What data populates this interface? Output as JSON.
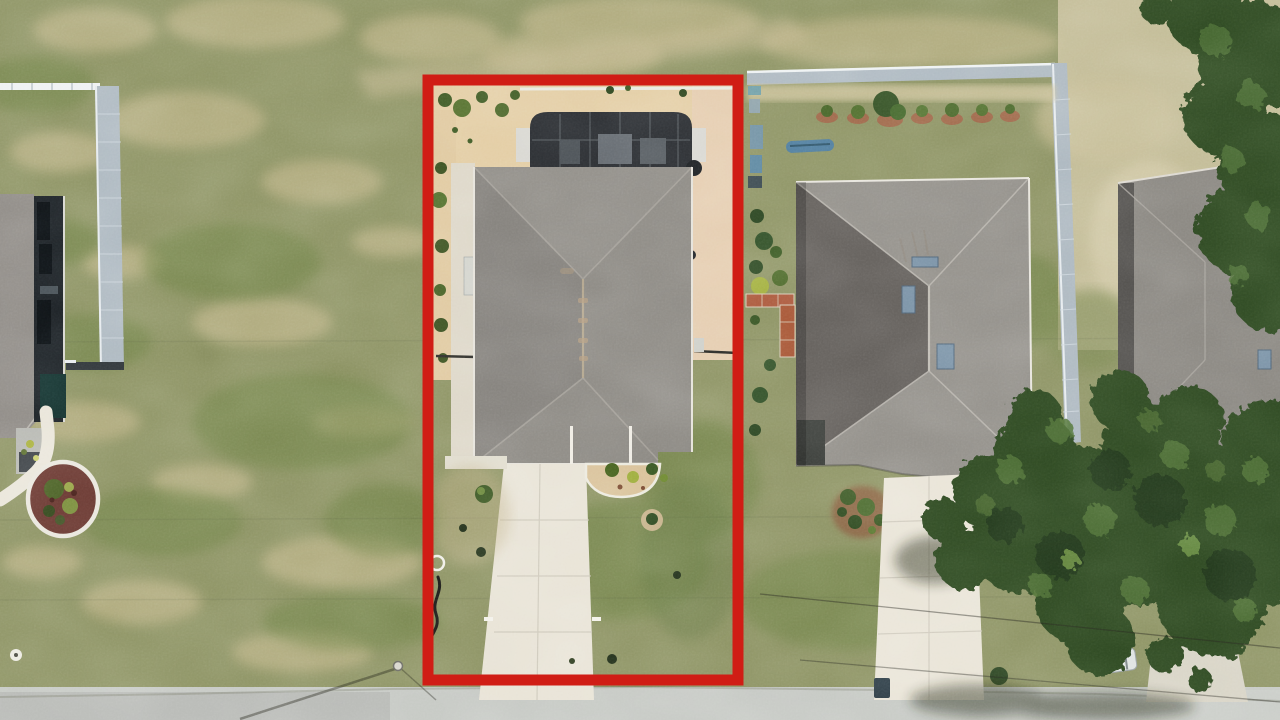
{
  "scene": {
    "kind": "aerial-drone-photo",
    "description": "Top-down aerial photo of a suburban single-family home lot highlighted with a red rectangular property-boundary outline, flanked by neighboring houses, lawns, driveways, a street along the bottom and tree canopy on the right.",
    "annotation": {
      "shape": "rectangle",
      "purpose": "subject-property-boundary-highlight"
    },
    "features": {
      "subject_lot": [
        "sandy backyard",
        "screened pool enclosure",
        "gray hip roof",
        "concrete driveway to street",
        "side paver patio"
      ],
      "left_neighbor": [
        "partial gray roof",
        "dark screened lanai",
        "gray privacy fence",
        "curved white walkway",
        "round mulch planting bed"
      ],
      "right_neighbor": [
        "gray hip roof with skylights",
        "privacy fence around backyard",
        "shrub row with mulch rings",
        "blue kayak",
        "concrete driveway",
        "trash bin"
      ],
      "far_right": [
        "partial third house roof",
        "large oak tree canopy",
        "white parked car",
        "second driveway"
      ],
      "street": "light concrete road along bottom edge with utility pole and power lines"
    }
  },
  "colors": {
    "boundary_red": "#d01d15",
    "grass_base": "#8e9465",
    "street": "#c6c9c4",
    "sand": "#e3cda4",
    "paver": "#e5cdb0",
    "roof_subject": "#8d8a84",
    "roof_right": "#93908a",
    "roof_left": "#908c87",
    "roof_far": "#8a8781",
    "enclosure_dark": "#2a2d31",
    "driveway": "#e8e3d6",
    "fence_gray": "#aeb9c1",
    "fence_rail_white": "#eef1f2",
    "tree_dark": "#2e4824",
    "tree_light": "#4e7134",
    "mulch_red": "#6b3a33",
    "brick_path": "#ad5c40",
    "kayak_blue": "#4f7d9e",
    "skylight_blue": "#7b93a7",
    "car_white": "#dfe3e1"
  }
}
